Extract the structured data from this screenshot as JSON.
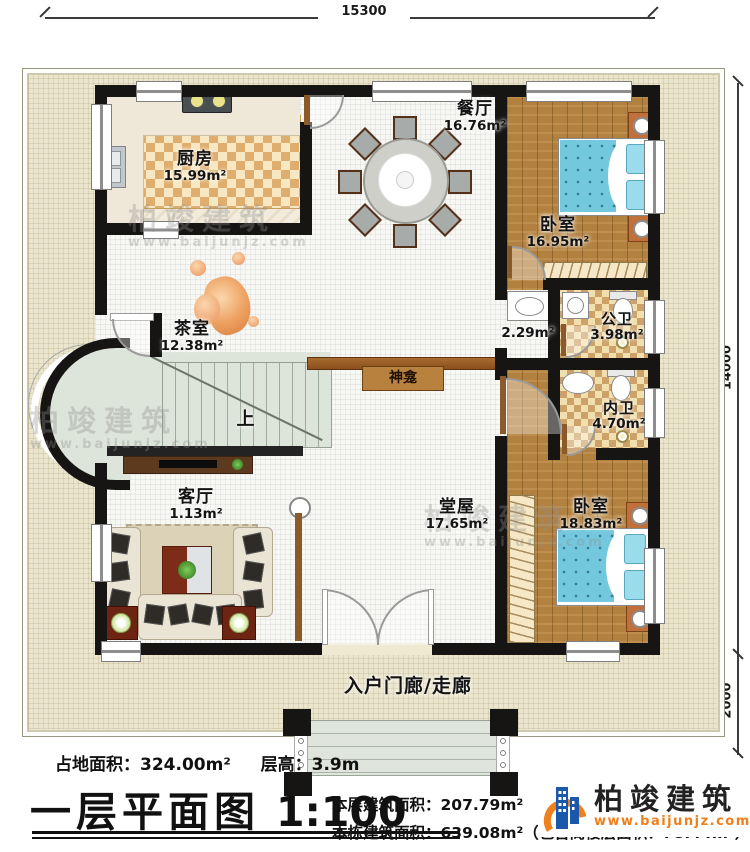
{
  "dimensions": {
    "top": "15300",
    "right_main": "14000",
    "right_porch": "2000"
  },
  "rooms": {
    "kitchen": {
      "name": "厨房",
      "area": "15.99m²"
    },
    "dining": {
      "name": "餐厅",
      "area": "16.76m²"
    },
    "bedroom_top": {
      "name": "卧室",
      "area": "16.95m²"
    },
    "hall_nook": {
      "area": "2.29m²"
    },
    "public_bath": {
      "name": "公卫",
      "area": "3.98m²"
    },
    "tea_room": {
      "name": "茶室",
      "area": "12.38m²"
    },
    "shrine": {
      "name": "神龛"
    },
    "inner_bath": {
      "name": "内卫",
      "area": "4.70m²"
    },
    "living": {
      "name": "客厅",
      "area": "1.13m²"
    },
    "main_hall": {
      "name": "堂屋",
      "area": "17.65m²"
    },
    "bedroom_bottom": {
      "name": "卧室",
      "area": "18.83m²"
    },
    "porch": {
      "name": "入户门廊/走廊"
    }
  },
  "stairs": {
    "up_label": "上"
  },
  "footer": {
    "land_area_label": "占地面积：",
    "land_area_value": "324.00m²",
    "floor_height_label": "层高：",
    "floor_height_value": "3.9m",
    "plan_title": "一层平面图",
    "scale": "1:100",
    "floor_area_label": "本层建筑面积：",
    "floor_area_value": "207.79m²",
    "building_area_label": "本栋建筑面积：",
    "building_area_value": "639.08m²",
    "attic_note": "（包含阁楼层面积：78.44m²）"
  },
  "logo": {
    "name": "柏竣建筑",
    "url": "www.baijunjz.com",
    "blue": "#1c58aa",
    "orange": "#f07f1d"
  },
  "watermark": {
    "text": "柏竣建筑",
    "url": "www.baijunjz.com"
  }
}
